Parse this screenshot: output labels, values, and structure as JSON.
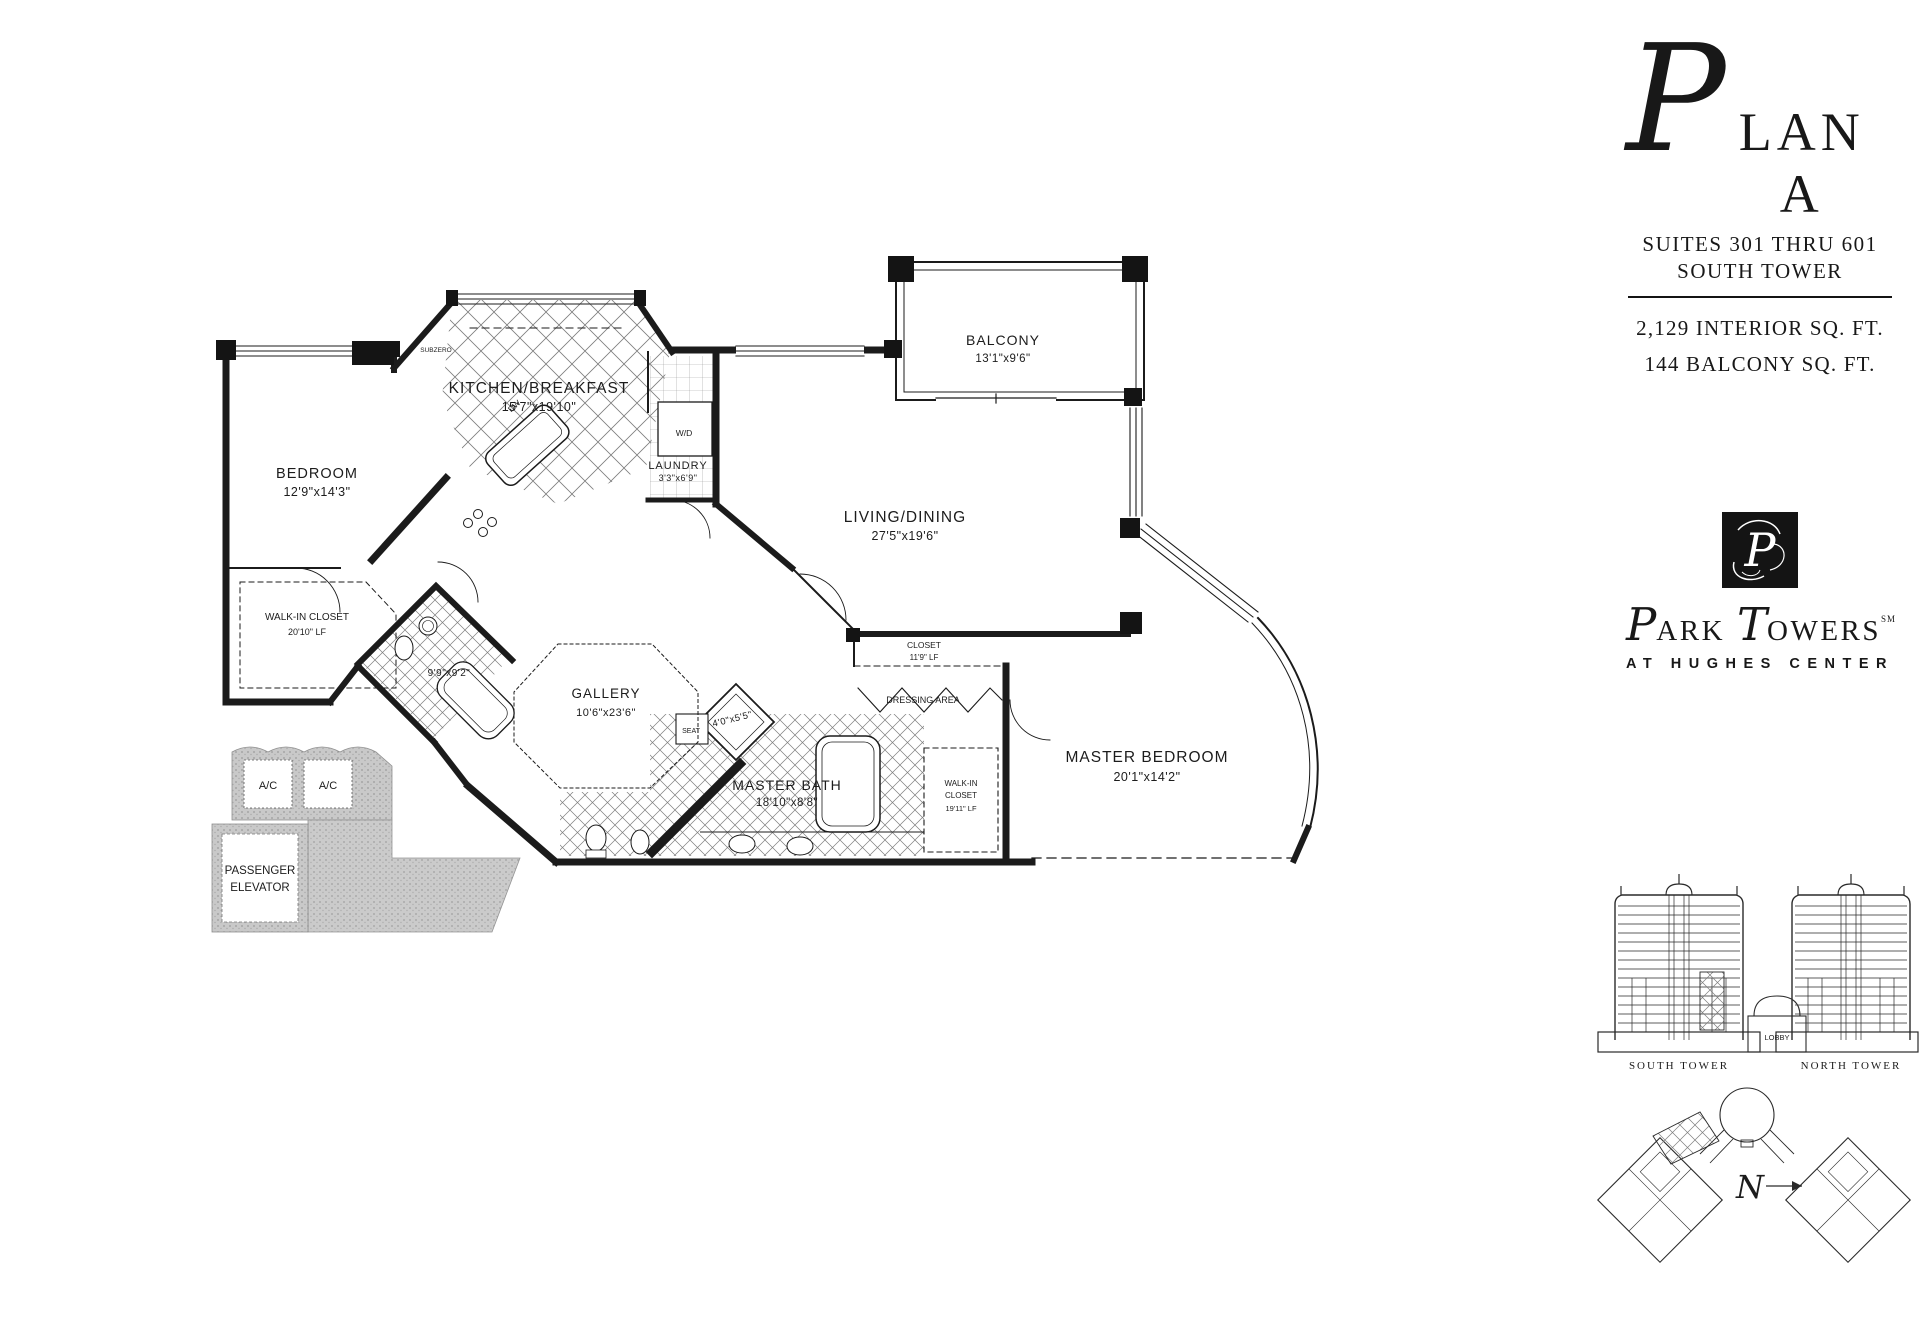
{
  "title_block": {
    "plan_script_letter": "P",
    "plan_title_rest": "LAN A",
    "suites": "SUITES 301 THRU 601",
    "tower": "SOUTH TOWER",
    "interior": "2,129 INTERIOR SQ. FT.",
    "balcony": "144 BALCONY SQ. FT."
  },
  "brand": {
    "monogram": "P",
    "name_initial_1": "P",
    "name_part_1": "ARK",
    "name_initial_2": "T",
    "name_part_2": "OWERS",
    "trademark": "SM",
    "tagline": "AT HUGHES CENTER"
  },
  "rooms": {
    "kitchen": {
      "label": "KITCHEN/BREAKFAST",
      "dims": "15'7\"x19'10\""
    },
    "bedroom": {
      "label": "BEDROOM",
      "dims": "12'9\"x14'3\""
    },
    "balcony": {
      "label": "BALCONY",
      "dims": "13'1\"x9'6\""
    },
    "living": {
      "label": "LIVING/DINING",
      "dims": "27'5\"x19'6\""
    },
    "laundry": {
      "label": "LAUNDRY",
      "dims": "3'3\"x6'9\""
    },
    "walkin_closet": {
      "label": "WALK-IN CLOSET",
      "dims": "20'10\" LF"
    },
    "bath2": {
      "dims": "9'9\"x9'2\""
    },
    "gallery": {
      "label": "GALLERY",
      "dims": "10'6\"x23'6\""
    },
    "shower": {
      "dims": "4'0\"x5'5\""
    },
    "master_bath": {
      "label": "MASTER BATH",
      "dims": "18'10\"x8'8\""
    },
    "closet": {
      "label": "CLOSET",
      "dims": "11'9\" LF"
    },
    "dressing": {
      "label": "DRESSING AREA"
    },
    "master_walkin": {
      "line1": "WALK-IN",
      "line2": "CLOSET",
      "dims": "19'11\" LF"
    },
    "master_bedroom": {
      "label": "MASTER BEDROOM",
      "dims": "20'1\"x14'2\""
    }
  },
  "fixtures": {
    "washer_dryer": "W/D",
    "seat": "SEAT",
    "subzero": "SUBZERO",
    "dishwasher": "DW"
  },
  "service": {
    "ac_left": "A/C",
    "ac_right": "A/C",
    "elevator_line1": "PASSENGER",
    "elevator_line2": "ELEVATOR"
  },
  "key_plan": {
    "south_tower": "SOUTH TOWER",
    "north_tower": "NORTH TOWER",
    "lobby": "LOBBY",
    "compass": "N"
  },
  "colors": {
    "ink": "#1b1b1b",
    "core_grey": "#c6c6c6",
    "hatch_grey": "#777777"
  }
}
